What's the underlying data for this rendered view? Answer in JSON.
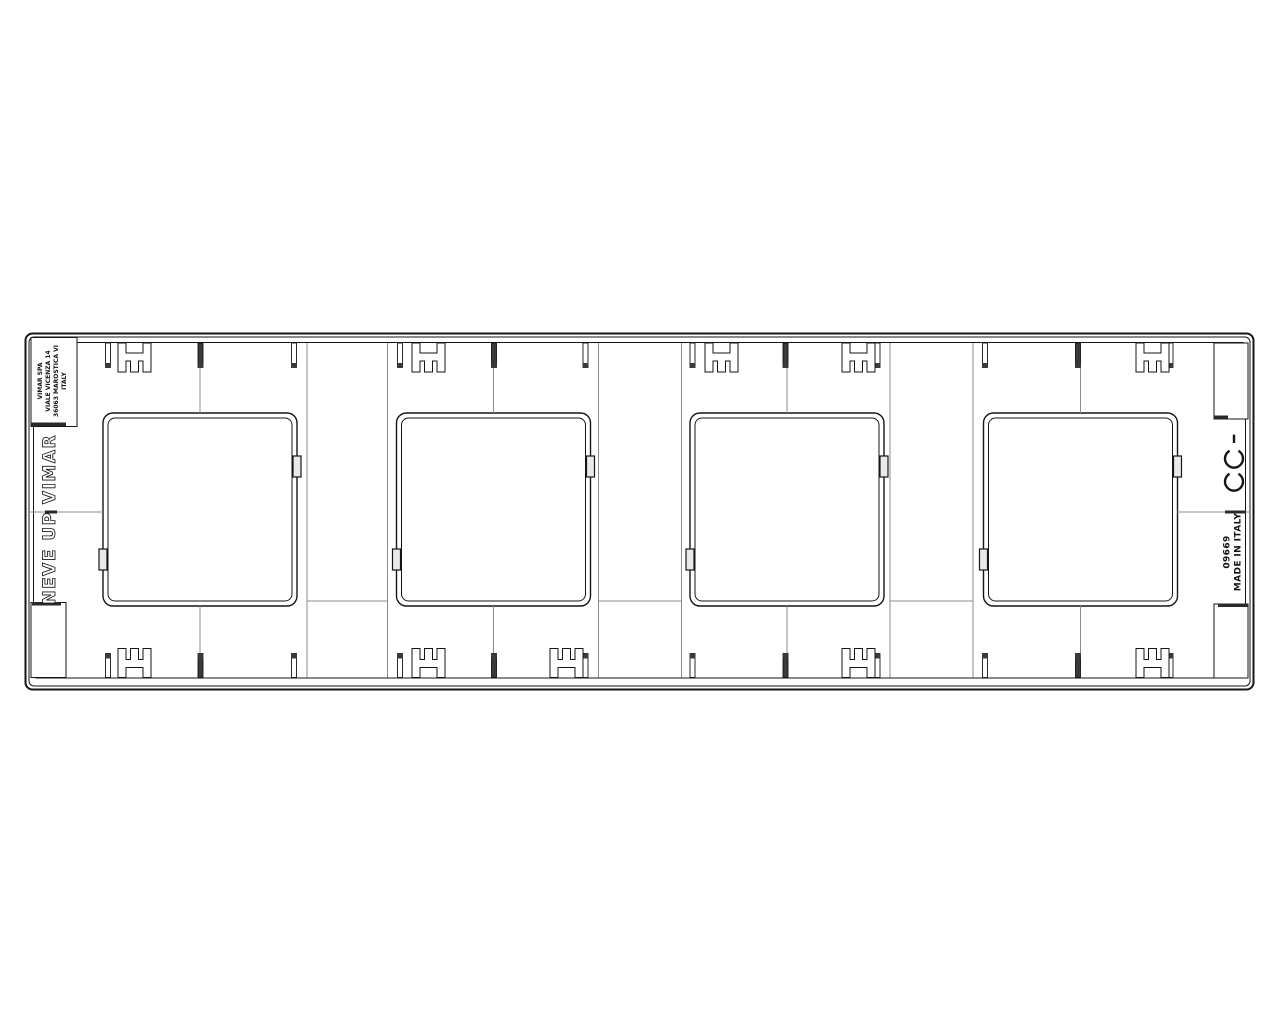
{
  "drawing": {
    "type": "technical-drawing",
    "subject": "4-gang cover plate, rear view",
    "series_label": "NEVE UP",
    "brand_label": "VIMAR",
    "manufacturer": {
      "line1": "VIMAR SPA",
      "line2": "VIALE VICENZA 14",
      "line3": "36063 MAROSTICA VI",
      "line4": "ITALY"
    },
    "product_code": "09669",
    "origin_label": "MADE IN ITALY",
    "ce_mark": "CE",
    "colors": {
      "background": "#ffffff",
      "line": "#151515",
      "hairline": "#8c8c8c",
      "fill_dark": "#3a3a3a"
    }
  }
}
